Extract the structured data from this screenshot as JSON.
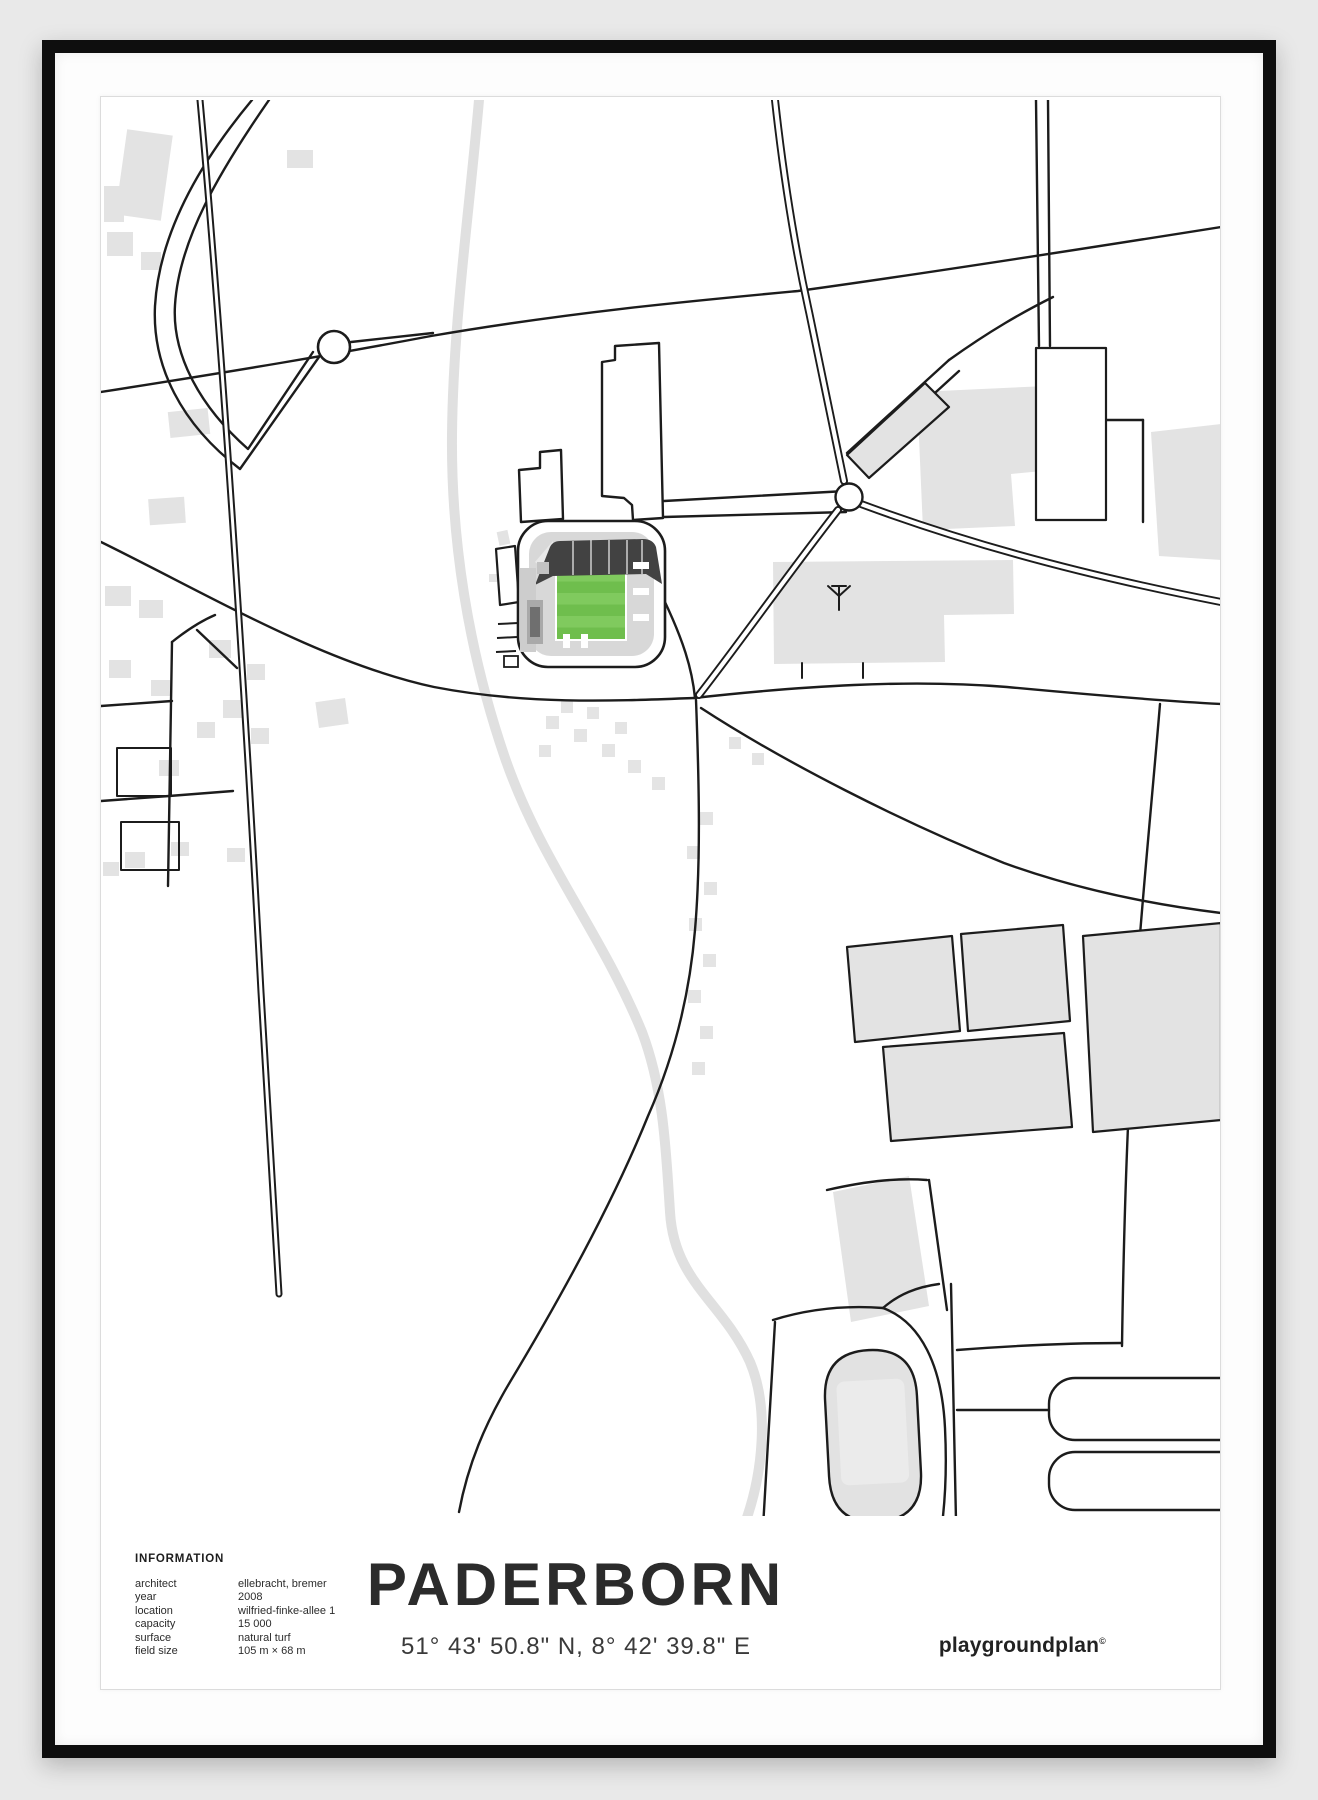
{
  "poster": {
    "title": "PADERBORN",
    "coordinates": "51° 43' 50.8\" N, 8° 42' 39.8\" E",
    "brand": "playgroundplan",
    "brand_mark": "©",
    "info": {
      "heading": "INFORMATION",
      "rows": [
        {
          "label": "architect",
          "value": "ellebracht, bremer"
        },
        {
          "label": "year",
          "value": "2008"
        },
        {
          "label": "location",
          "value": "wilfried-finke-allee 1"
        },
        {
          "label": "capacity",
          "value": "15 000"
        },
        {
          "label": "surface",
          "value": "natural turf"
        },
        {
          "label": "field size",
          "value": "105 m × 68 m"
        }
      ]
    },
    "colors": {
      "wall": "#e9e9e9",
      "frame": "#0e0e0e",
      "paper": "#ffffff",
      "road": "#1c1c1c",
      "building_gray": "#e3e3e3",
      "water_gray": "#e0e0e0",
      "stadium_roof": "#424242",
      "stadium_stand": "#d8d8d8",
      "pitch_green": "#6fbe4d",
      "pitch_green_stripe": "#80ca5e"
    },
    "map_features": [
      "stadium with green pitch",
      "railway line",
      "two roundabouts",
      "stream",
      "athletics track",
      "sports fields",
      "building clusters",
      "road network"
    ]
  }
}
